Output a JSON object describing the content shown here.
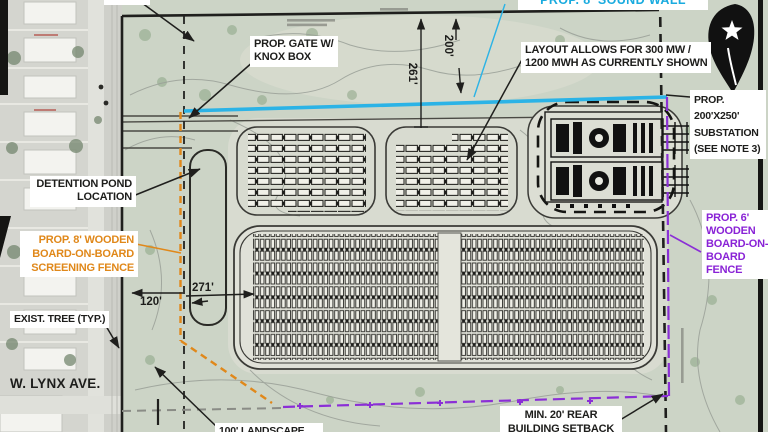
{
  "plan": {
    "callouts": {
      "sound_wall": "PROP. 8' SOUND WALL",
      "gate": [
        "PROP. GATE W/",
        "KNOX BOX"
      ],
      "layout": [
        "LAYOUT ALLOWS FOR 300 MW /",
        "1200 MWH AS CURRENTLY SHOWN"
      ],
      "substation": [
        "PROP.",
        "200'X250'",
        "SUBSTATION",
        "(SEE NOTE 3)"
      ],
      "detention": [
        "DETENTION POND",
        "LOCATION"
      ],
      "screen_fence": [
        "PROP. 8' WOODEN",
        "BOARD-ON-BOARD",
        "SCREENING FENCE"
      ],
      "exist_tree": "EXIST. TREE (TYP.)",
      "street": "W. LYNX AVE.",
      "fence6": [
        "PROP. 6'",
        "WOODEN",
        "BOARD-ON-",
        "BOARD",
        "FENCE"
      ],
      "setback": [
        "MIN. 20' REAR",
        "BUILDING SETBACK"
      ],
      "landscape": "100' LANDSCAPE"
    },
    "dimensions": {
      "d200": "200'",
      "d261": "261'",
      "d120": "120'",
      "d271": "271'"
    },
    "colors": {
      "sound_wall": "#2bb3e6",
      "screen_fence": "#e0881a",
      "fence6": "#8b2fd6",
      "boundary": "#1f1f1d"
    }
  }
}
